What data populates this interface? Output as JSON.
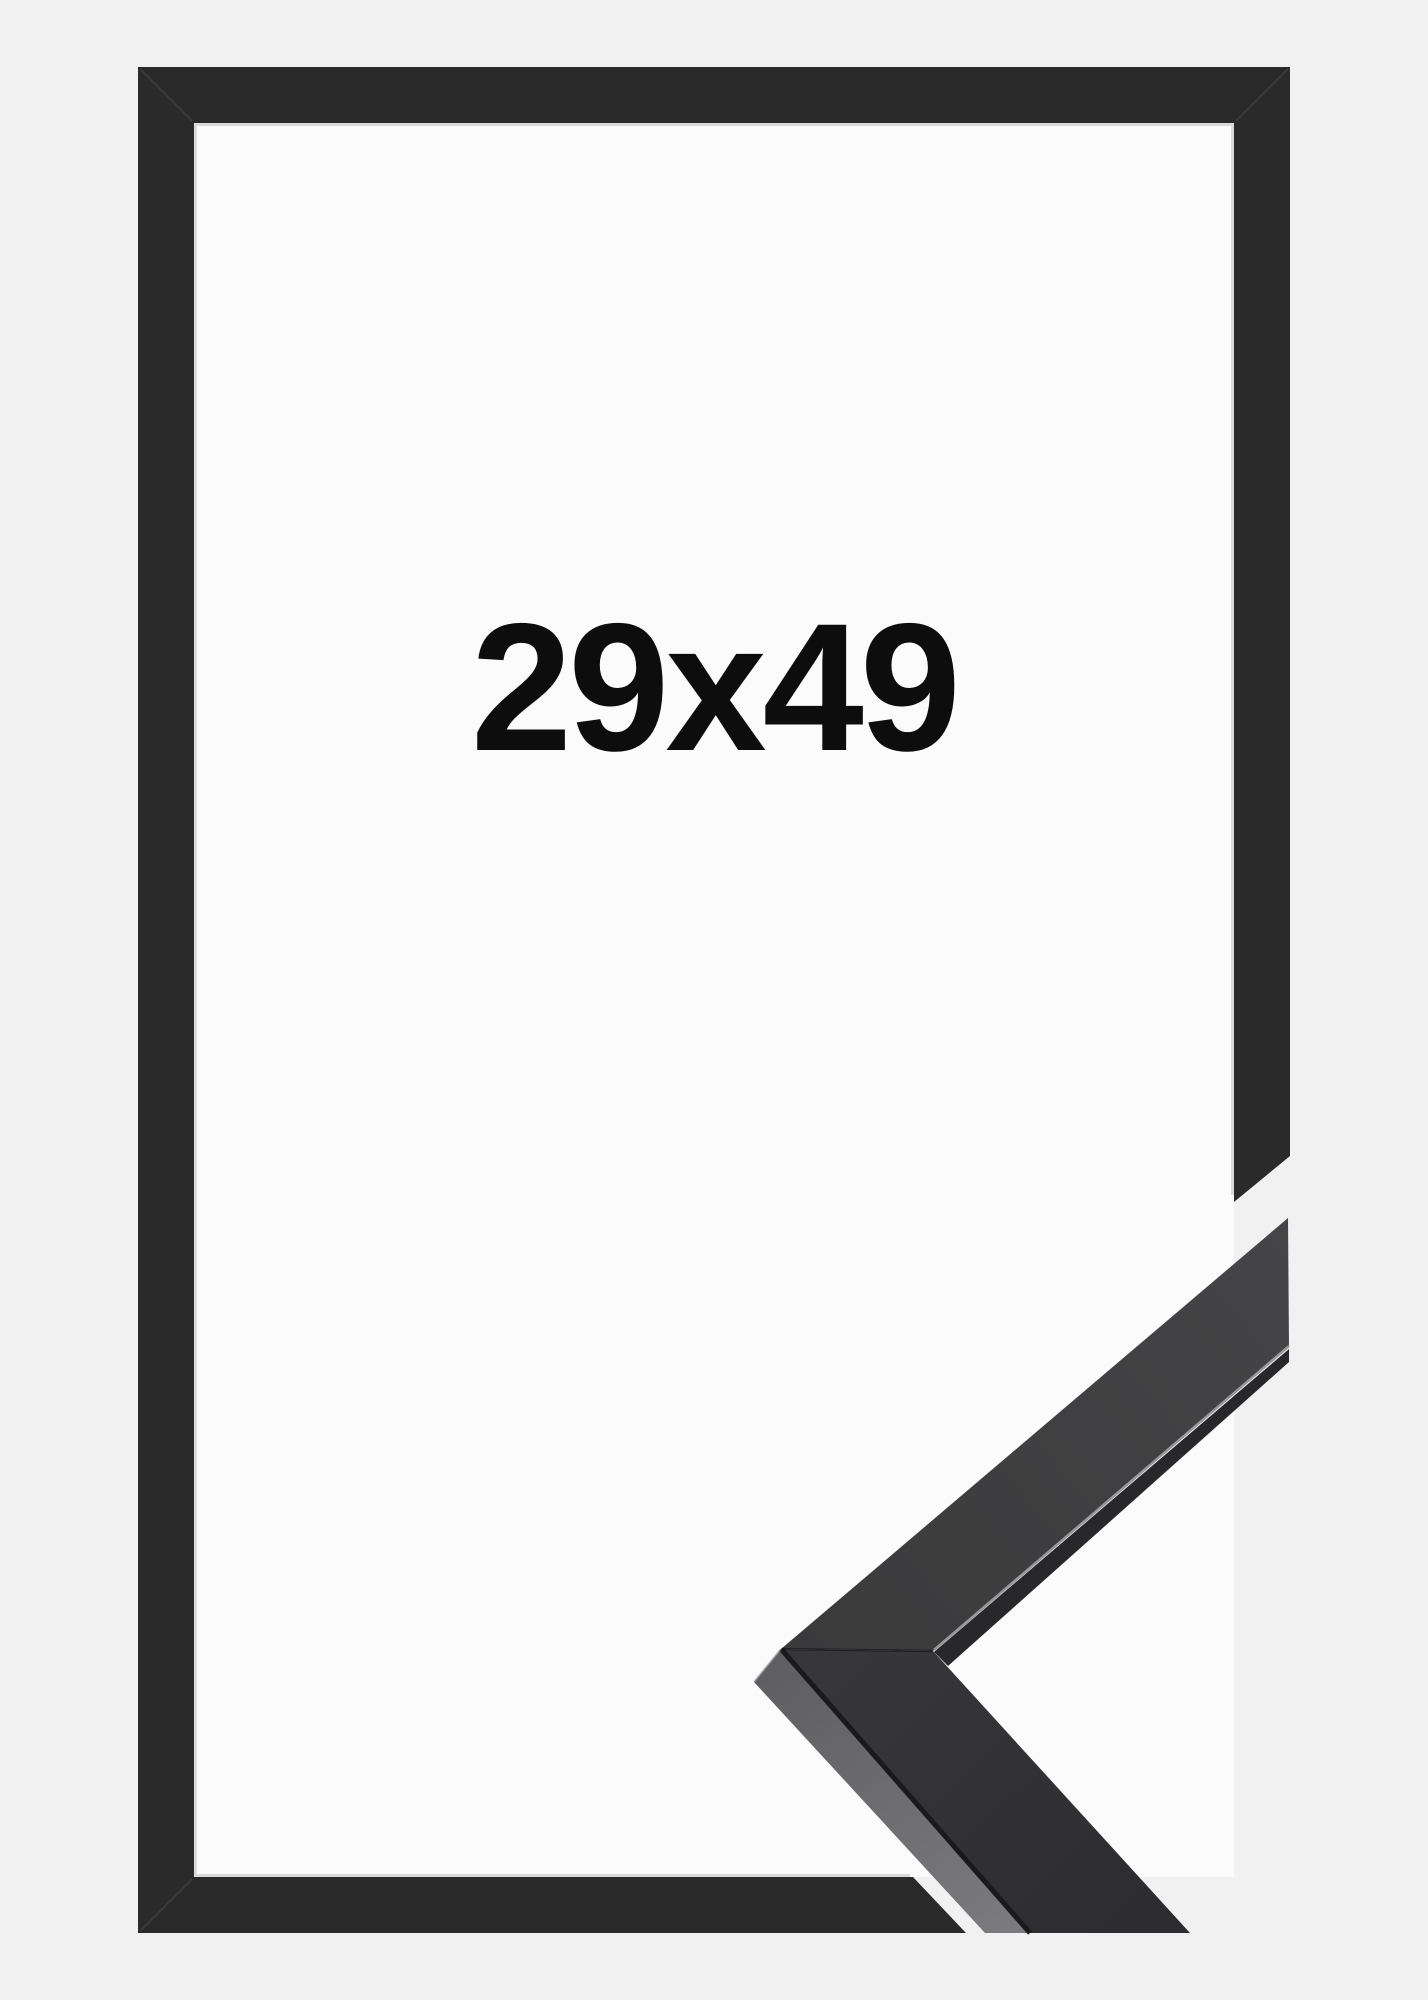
{
  "size_label": {
    "text": "29x49"
  },
  "colors": {
    "background": "#f1f1f2",
    "inner_area": "#fbfbfb",
    "inner_edge": "#dadadc",
    "frame": "#2a2a2b",
    "miter_line": "rgba(255,255,255,0.08)",
    "profile_face_light": "#454547",
    "profile_face_mid": "#3a3a3b",
    "profile_face_lower_1": "#37373a",
    "profile_face_lower_2": "#2d2d2f",
    "profile_side_1": "#5e5e60",
    "profile_side_2": "#7b7b7e",
    "profile_sliver": "#28282a",
    "profile_highlight": "#98989b",
    "profile_crease": "#1a1a1b",
    "profile_seam": "rgba(0,0,0,0.4)",
    "label": "#0d0d0d"
  }
}
